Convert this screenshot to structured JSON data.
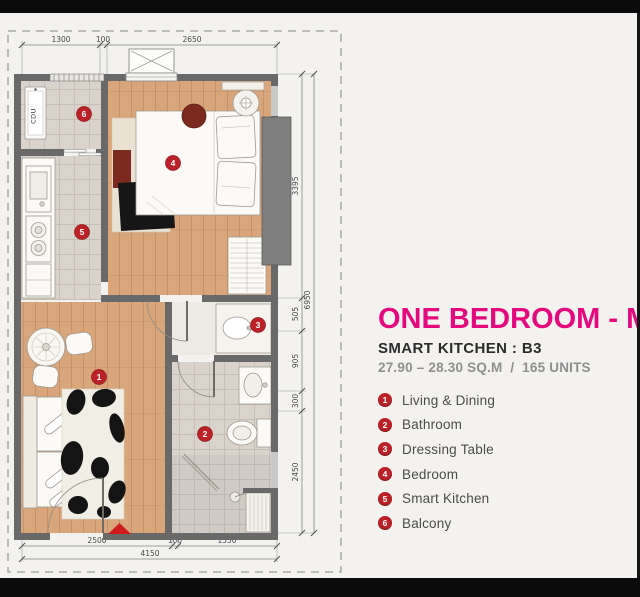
{
  "panel": {
    "title": "ONE BEDROOM - M",
    "subtitle": "SMART KITCHEN : B3",
    "area_line": "27.90 – 28.30 SQ.M  /  165 UNITS",
    "legend": [
      {
        "num": "1",
        "label": "Living & Dining"
      },
      {
        "num": "2",
        "label": "Bathroom"
      },
      {
        "num": "3",
        "label": "Dressing Table"
      },
      {
        "num": "4",
        "label": "Bedroom"
      },
      {
        "num": "5",
        "label": "Smart Kitchen"
      },
      {
        "num": "6",
        "label": "Balcony"
      }
    ]
  },
  "plan": {
    "markers": [
      "1",
      "2",
      "3",
      "4",
      "5",
      "6"
    ],
    "labels": {
      "cdu": "CDU"
    },
    "dims": {
      "top": [
        "1300",
        "100",
        "2650"
      ],
      "bottom": [
        "2500",
        "100",
        "1550"
      ],
      "bottom_total": "4150",
      "right": [
        "3395",
        "505",
        "905",
        "300",
        "2450"
      ],
      "right_total": "6950"
    }
  },
  "colors": {
    "accent_magenta": "#e5097e",
    "badge_red": "#bb2126",
    "wood_floor": "#d9a67c",
    "tile_floor": "#d9d3cc",
    "wall_gray": "#696969"
  }
}
